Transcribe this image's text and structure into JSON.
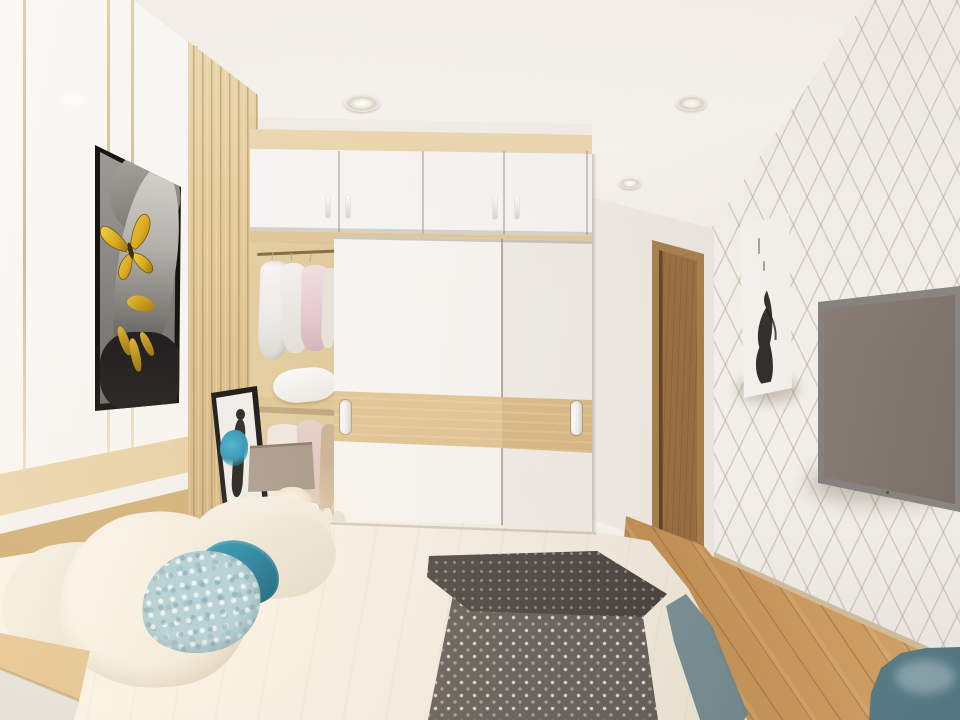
{
  "scene": {
    "type": "natural-image",
    "description": "3D interior rendering of a modern bedroom with built-in wardrobe, wall-mounted TV and double bed",
    "room": "bedroom",
    "text_visible": "none"
  },
  "palette": {
    "ceiling": "#f3efe8",
    "left_wall": "#f4f1ec",
    "gold_strip": "#d3bd8e",
    "wood_light": "#e0c595",
    "wood_slats": "#d8bc8b",
    "wardrobe_white": "#f5f3ef",
    "door_wood": "#a57c4c",
    "wallpaper": "#f2efe9",
    "wallpaper_line": "#9e9482",
    "floor_oak": "#c3945c",
    "tv_frame": "#8e8b86",
    "tv_screen": "#7a6f62",
    "bedding_white": "#f4efe6",
    "runner_gray": "#57524b",
    "runner_dots": "#e8e3d9",
    "pillow_teal": "#187f9e",
    "pillow_mottled_blue": "#aecdd6",
    "lamp_shade": "#b3a494",
    "leaning_art_accent": "#3aa8c8",
    "butterfly_gold": "#d9ab22",
    "chair_teal_gray": "#6d95a0",
    "headboard_wood": "#d4b279"
  },
  "objects": [
    {
      "name": "ceiling-spotlights",
      "count": 3,
      "state": "off"
    },
    {
      "name": "left-wall-panels",
      "detail": "glossy white panels with 4 vertical gold strips"
    },
    {
      "name": "butterfly-portrait-art",
      "detail": "black-framed grayscale portrait of a woman with gold butterfly over eye, gold lips and fingers"
    },
    {
      "name": "wood-slat-panel",
      "detail": "vertical light-wood slats beside artwork"
    },
    {
      "name": "wardrobe-upper-cabinets",
      "doors": 4,
      "handles": 4,
      "color": "white"
    },
    {
      "name": "open-closet-section",
      "contents": [
        "white garment",
        "cream garment",
        "pink garment",
        "white pillow on shelf",
        "lower garments"
      ]
    },
    {
      "name": "sliding-wardrobe-doors",
      "doors": 2,
      "handles": 2,
      "detail": "white doors with horizontal light-wood band"
    },
    {
      "name": "table-lamp",
      "state": "on",
      "detail": "taupe drum shade, glowing cream base"
    },
    {
      "name": "leaning-art-frame",
      "detail": "black frame, white print with dark figure and teal accent"
    },
    {
      "name": "interior-door",
      "detail": "light-brown wood door in back alcove"
    },
    {
      "name": "diamond-wallpaper-wall",
      "detail": "white wall with gray diamond lattice pattern"
    },
    {
      "name": "ink-canvas-art",
      "detail": "white canvas with black ink figure and small calligraphy marks"
    },
    {
      "name": "wall-mounted-tv",
      "detail": "gray-framed TV with warm brown screen reflection"
    },
    {
      "name": "wood-floor",
      "detail": "oak planks laid diagonally"
    },
    {
      "name": "bed",
      "detail": "white duvet with dark-gray patterned runner folded at foot"
    },
    {
      "name": "pillows",
      "colors": [
        "cream striped",
        "cream striped",
        "cream",
        "cream",
        "solid teal",
        "mottled light blue"
      ]
    },
    {
      "name": "nightstand",
      "detail": "wood top, white drawer front"
    },
    {
      "name": "accent-chair",
      "detail": "teal-gray chair back in bottom-right corner"
    },
    {
      "name": "gray-bed-edge-throw",
      "detail": "gray-blue textured edge at right side of bed"
    }
  ]
}
